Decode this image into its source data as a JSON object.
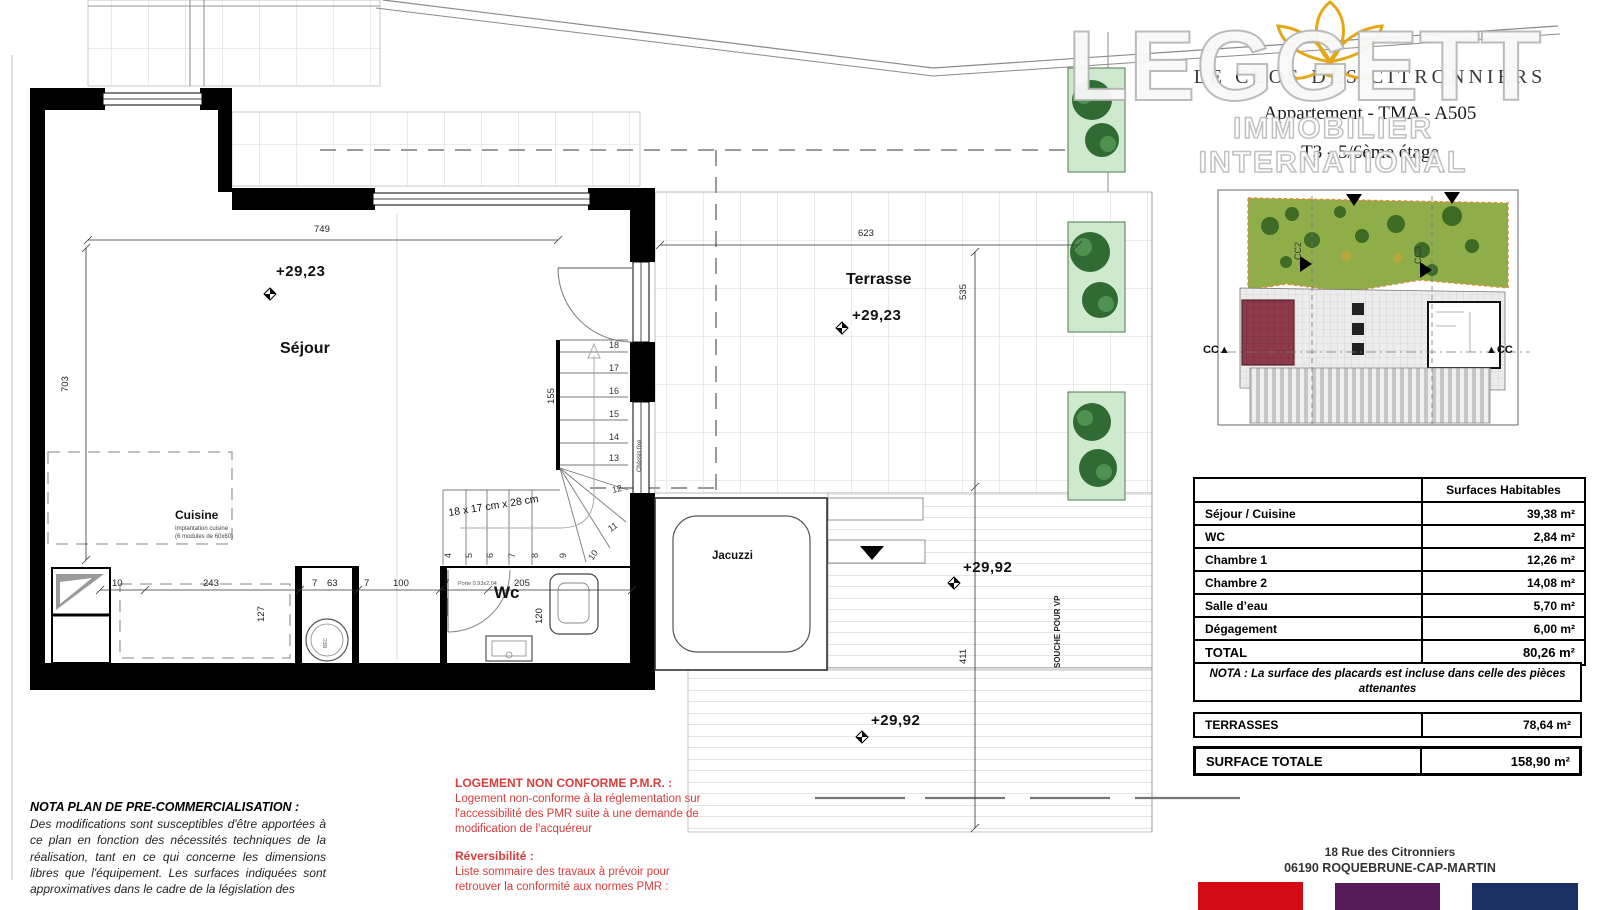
{
  "watermark": {
    "brand": "LEGGETT",
    "tagline": "IMMOBILIER INTERNATIONAL"
  },
  "header": {
    "project": "LE CLOS DES CITRONNIERS",
    "apartment": "Appartement - TMA - A505",
    "floor": "T3 - 5/6ème étage"
  },
  "plan": {
    "rooms": {
      "sejour": "Séjour",
      "cuisine": "Cuisine",
      "cuisine_note1": "Implantation cuisine",
      "cuisine_note2": "(6 modules de 60x60)",
      "wc": "Wc",
      "terrasse": "Terrasse",
      "jacuzzi": "Jacuzzi"
    },
    "levels": {
      "sejour": "+29,23",
      "terrasse": "+29,23",
      "deck_upper": "+29,92",
      "deck_lower": "+29,92"
    },
    "dims": {
      "top": "749",
      "left": "703",
      "terrasse_width": "623",
      "terrasse_depth": "535",
      "deck_depth": "411",
      "kitchen_depth": "127",
      "wc_depth": "120",
      "stair_width": "155",
      "chain": [
        "10",
        "243",
        "7",
        "63",
        "7",
        "100",
        "7",
        "205"
      ]
    },
    "stair": {
      "note": "18 x 17 cm x 28 cm",
      "numbers_vertical": [
        "18",
        "17",
        "16",
        "15",
        "14",
        "13"
      ],
      "numbers_fan": [
        "12",
        "11",
        "10"
      ],
      "numbers_run": [
        "9",
        "8",
        "7",
        "6",
        "5",
        "4"
      ],
      "chassis": "Châssis fixe"
    },
    "misc": {
      "souche": "SOUCHE POUR VP",
      "porte": "Porte 0.93x2.04",
      "bec": "BEC"
    }
  },
  "minimap": {
    "cc2": "CC2",
    "cc3": "CC3",
    "cc_left": "CC▲",
    "cc_right": "▲CC"
  },
  "surfaces": {
    "header": "Surfaces Habitables",
    "rows": [
      {
        "label": "Séjour / Cuisine",
        "value": "39,38 m²"
      },
      {
        "label": "WC",
        "value": "2,84 m²"
      },
      {
        "label": "Chambre 1",
        "value": "12,26 m²"
      },
      {
        "label": "Chambre 2",
        "value": "14,08 m²"
      },
      {
        "label": "Salle d’eau",
        "value": "5,70 m²"
      },
      {
        "label": "Dégagement",
        "value": "6,00 m²"
      }
    ],
    "total_label": "TOTAL",
    "total_value": "80,26 m²"
  },
  "nota_box": "NOTA : La surface des placards est incluse dans celle des pièces attenantes",
  "terrasses": {
    "label": "TERRASSES",
    "value": "78,64 m²"
  },
  "surface_totale": {
    "label": "SURFACE TOTALE",
    "value": "158,90 m²"
  },
  "address": {
    "line1": "18 Rue des Citronniers",
    "line2": "06190 ROQUEBRUNE-CAP-MARTIN"
  },
  "footnote": {
    "title": "NOTA PLAN DE PRE-COMMERCIALISATION :",
    "body": "Des modifications sont susceptibles d'être apportées à ce plan en fonction des nécessités techniques de la réalisation, tant en ce qui concerne les dimensions libres que l'équipement. Les surfaces indiquées sont approximatives dans le cadre de la législation des"
  },
  "pmr": {
    "title": "LOGEMENT NON CONFORME P.M.R. :",
    "body": "Logement non-conforme à la réglementation sur l'accessibilité des PMR suite à une demande de modification de l'acquéreur",
    "rev_title": "Réversibilité :",
    "rev_body": "Liste sommaire des travaux à prévoir pour retrouver la conformité aux normes PMR :"
  },
  "colors": {
    "swatch_red": "#d40b14",
    "swatch_purple": "#571a59",
    "swatch_navy": "#1a2f63",
    "logo_gold": "#e7a714",
    "planter_green": "#cfe9cf",
    "garden_green": "#8fae4a",
    "unit_red": "#8e3a4a",
    "note_red": "#d93c3c"
  }
}
